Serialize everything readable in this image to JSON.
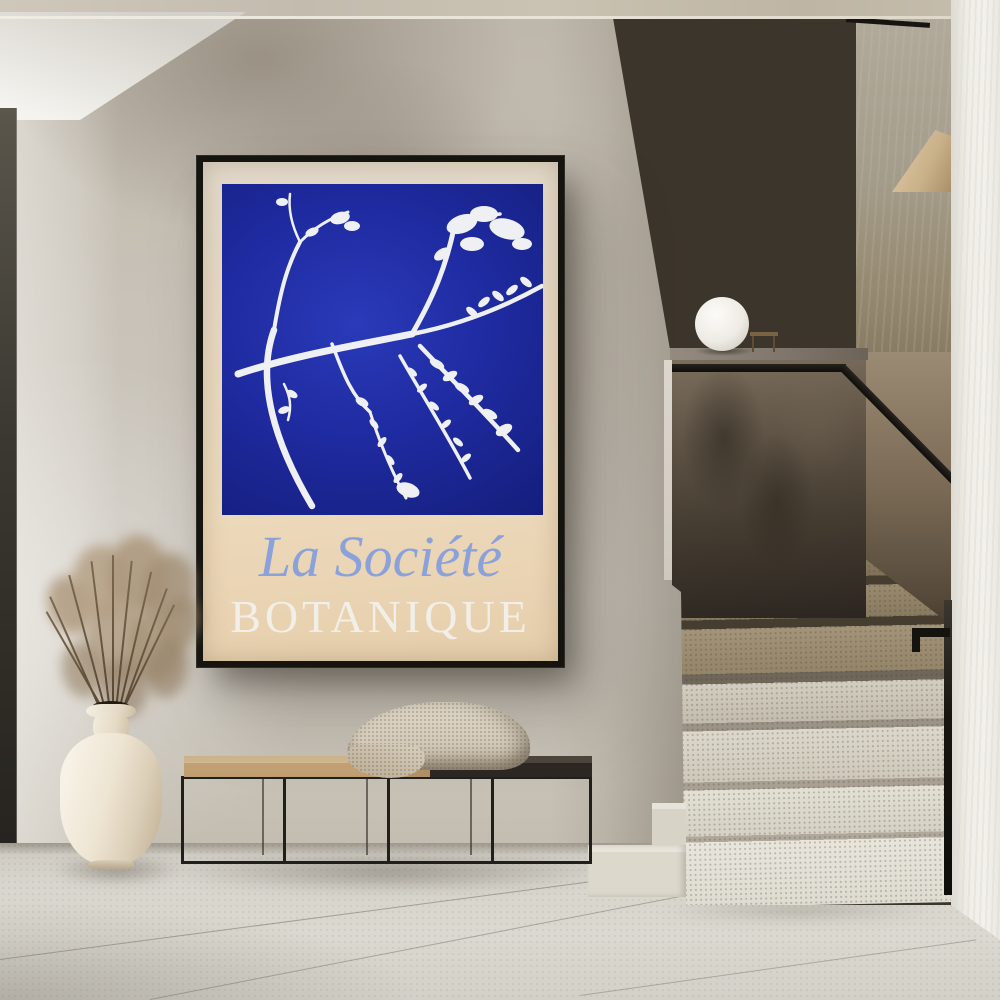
{
  "scene": {
    "type": "interior-photograph",
    "description": "Minimalist concrete hallway with a framed botanical art poster above a black metal bench, a cream vase with dried grass, and a terrazzo staircase with black handrail and glass-sphere lamp"
  },
  "poster": {
    "title_line1": "La Société",
    "title_line2": "BOTANIQUE",
    "art_description": "white branch silhouette on deep blue square",
    "colors": {
      "art_blue": "#1f2ba1",
      "poster_background": "#e8d7bd",
      "line1_text": "#8ba1da",
      "line2_text": "#f2efe8",
      "frame": "#16140f"
    }
  },
  "objects": [
    {
      "name": "framed-poster",
      "color": "#16140f"
    },
    {
      "name": "sphere-lamp",
      "color": "#f2f0ec"
    },
    {
      "name": "stair-handrail",
      "color": "#15130e"
    },
    {
      "name": "terrazzo-steps",
      "color": "#d8d4c8"
    },
    {
      "name": "bench",
      "color": "#211f1b"
    },
    {
      "name": "woven-blanket",
      "color": "#d5cbba"
    },
    {
      "name": "decorative-stones",
      "color": "#211e1a"
    },
    {
      "name": "ceramic-vase",
      "color": "#eee5d3"
    },
    {
      "name": "dried-grass",
      "color": "#ab957c"
    }
  ]
}
